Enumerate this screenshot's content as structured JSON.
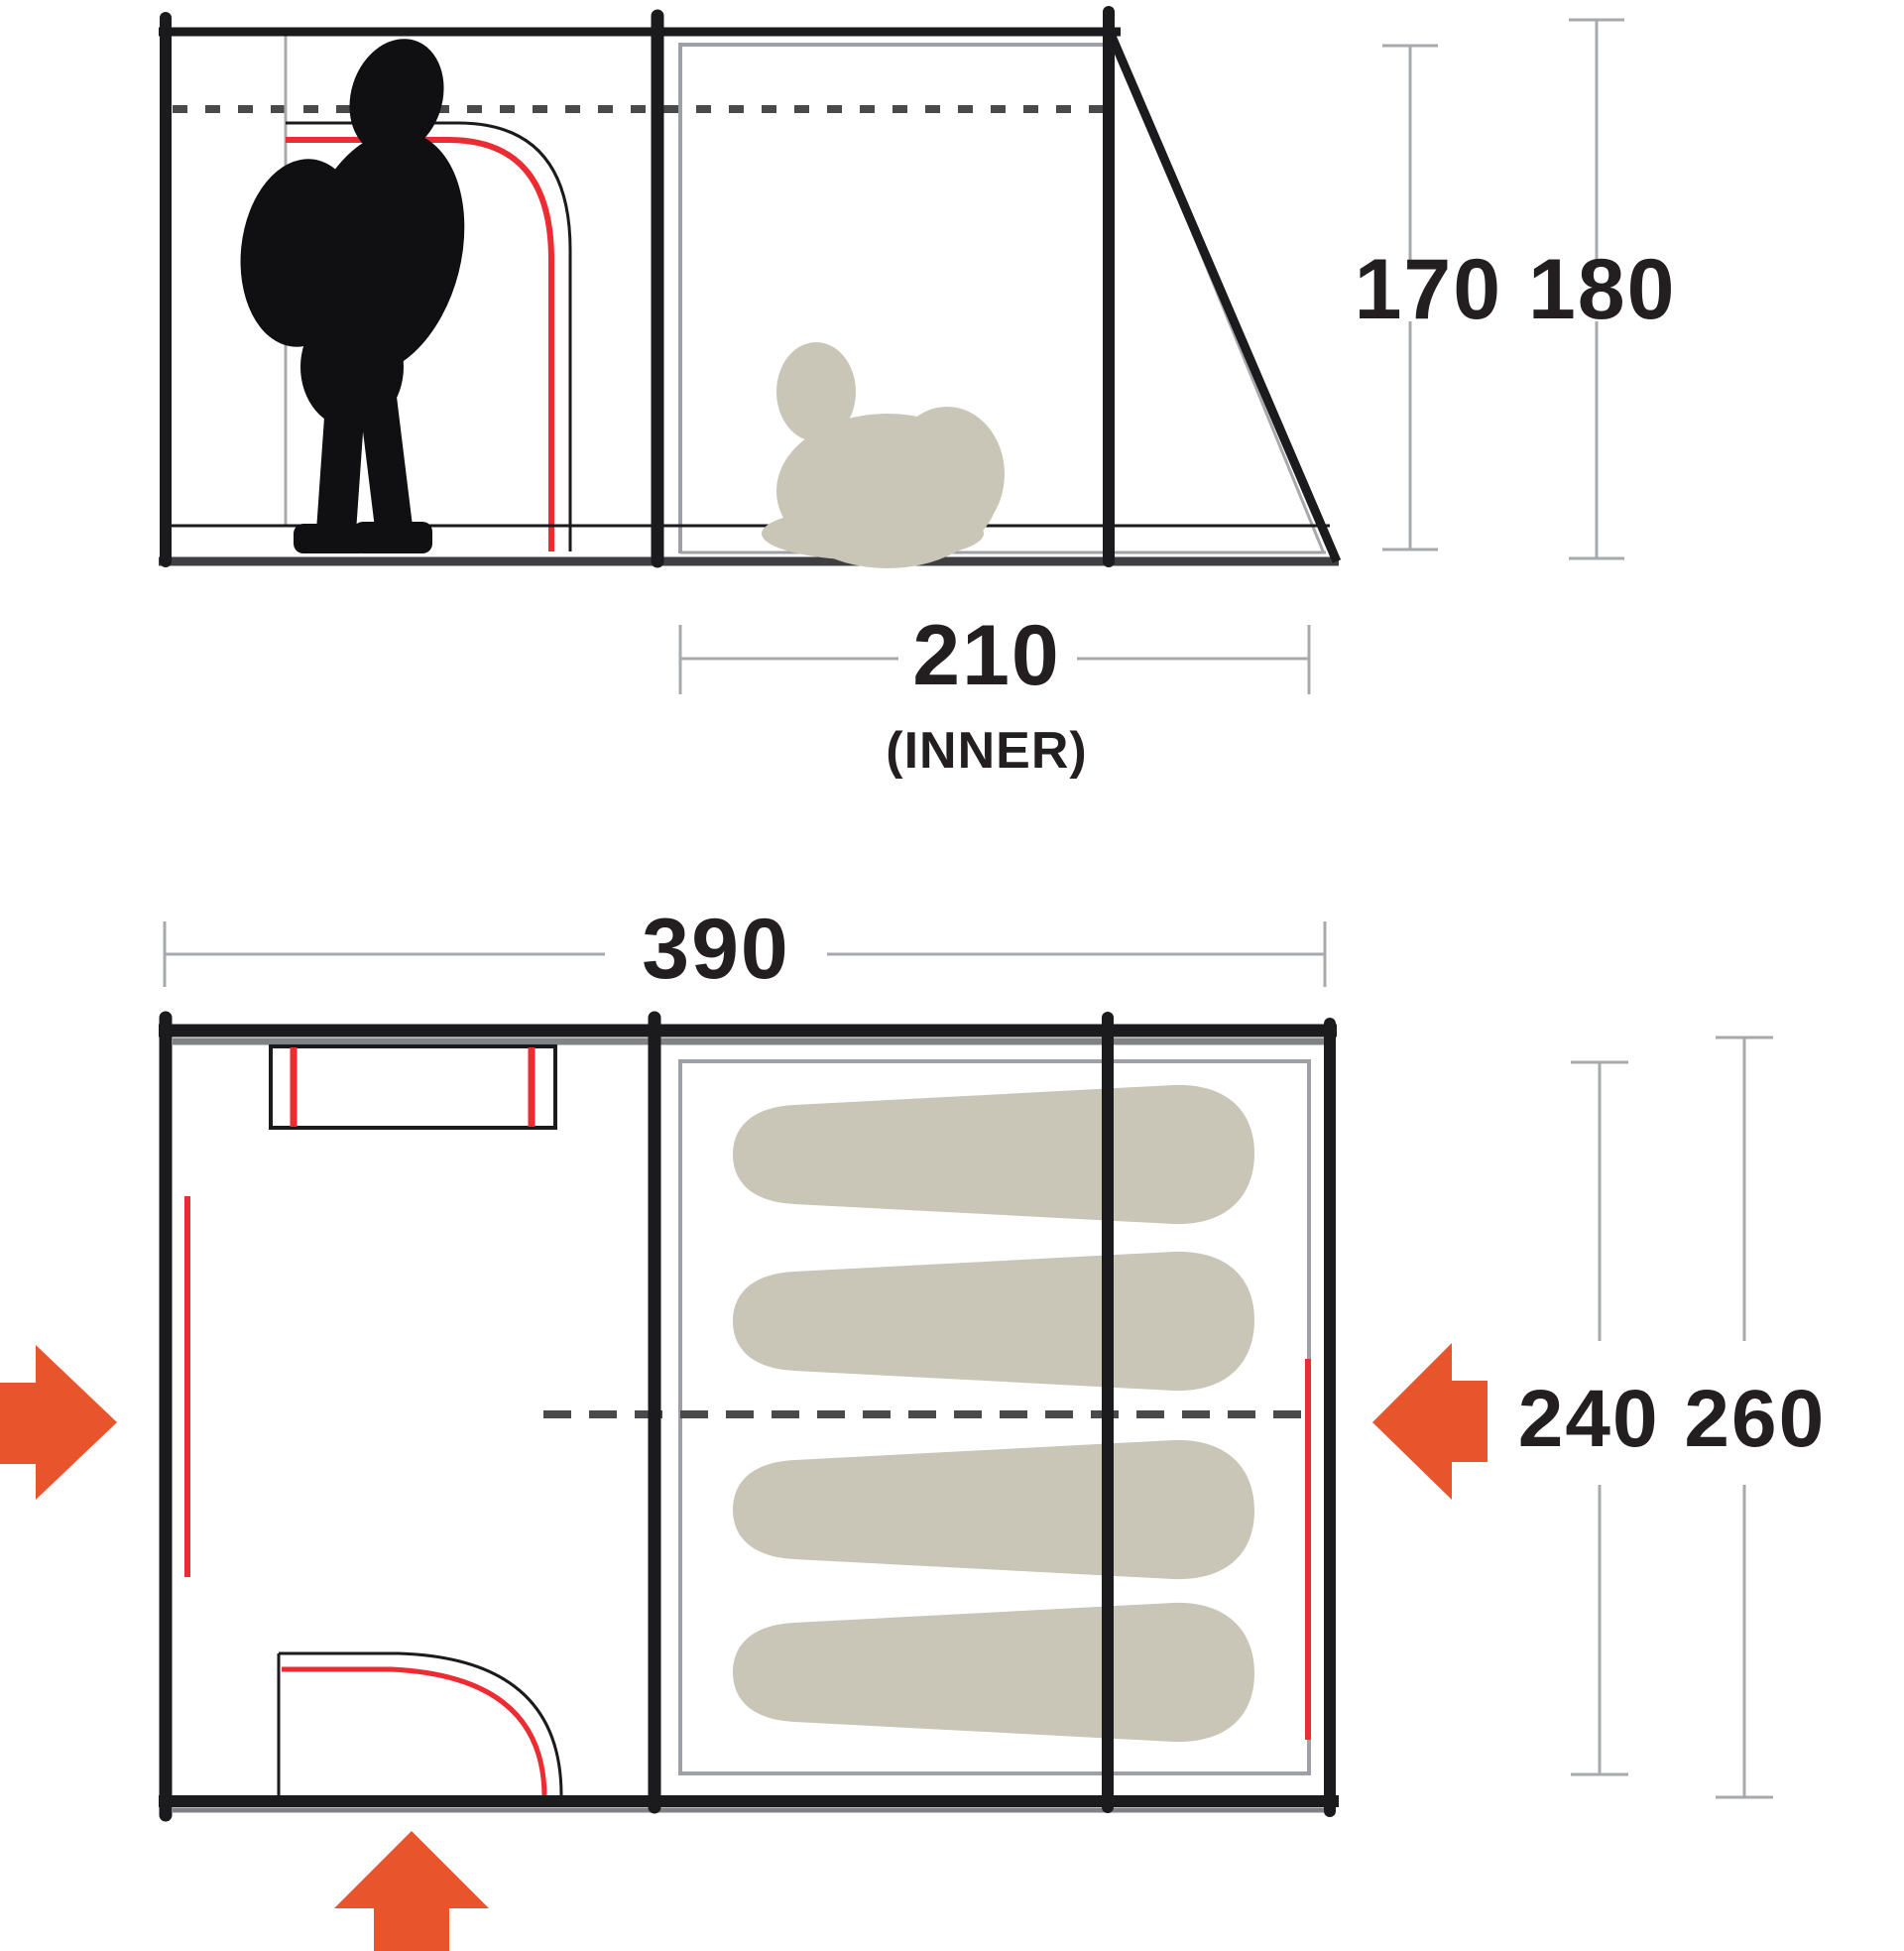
{
  "side_view": {
    "inner_width": "210",
    "inner_width_note": "(INNER)",
    "heights": "170 180"
  },
  "floor_plan": {
    "outer_width": "390",
    "depths": "240 260"
  },
  "colors": {
    "structure_black": "#1B1B1E",
    "base_dark": "#3F3F42",
    "dim_gray": "#A7A9AC",
    "inner_outline_gray": "#9EA0A5",
    "shadow_gray": "#808285",
    "dash_gray": "#4A4A4C",
    "door_red": "#EC2B33",
    "arrow_orange": "#E8542B",
    "figure_beige": "#CAC6B7",
    "text": "#231F20"
  },
  "icons": {
    "entrance_left": "arrow-right-icon",
    "entrance_right": "arrow-left-icon",
    "entrance_front": "arrow-up-icon",
    "standing_figure": "standing-person-silhouette",
    "sitting_figure": "sitting-person-silhouette",
    "sleeping_mat": "sleeping-bag-shape"
  }
}
